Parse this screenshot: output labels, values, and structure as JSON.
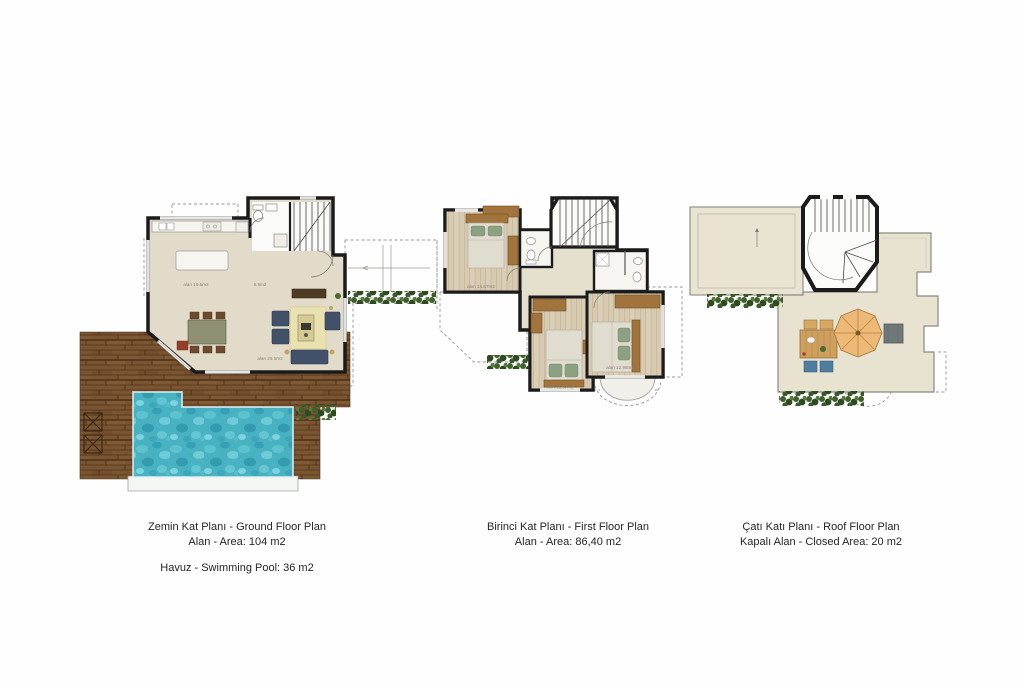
{
  "page": {
    "background": "#fefefe"
  },
  "plans": {
    "ground": {
      "caption1": "Zemin Kat Planı - Ground Floor Plan",
      "caption2": "Alan - Area: 104 m2",
      "caption3": "Havuz - Swimming Pool: 36 m2",
      "labels": {
        "kitchen": "alan 19.5m2",
        "hall": "9.5m2",
        "living": "alan 29.5m2"
      }
    },
    "first": {
      "caption1": "Birinci Kat Planı - First Floor Plan",
      "caption2": "Alan - Area: 86,40 m2",
      "labels": {
        "bedroom1": "alan 14.67m2",
        "bedroom2": "alan 11.57m2",
        "bedroom3": "alan 12.98m2"
      }
    },
    "roof": {
      "caption1": "Çatı Katı Planı - Roof Floor Plan",
      "caption2": "Kapalı Alan - Closed Area: 20 m2"
    }
  },
  "colors": {
    "wall": "#1b1b1b",
    "floor_beige": "#e2dbc9",
    "floor_wood_light": "#d8cab1",
    "deck_wood": "#7a5531",
    "pool_water": "#49b2c2",
    "hedge_green": "#3a5a2b",
    "sofa_blue": "#41516a",
    "rug_yellow": "#e9e1b0",
    "furniture_brown": "#a1743d",
    "umbrella_tan": "#ecb977",
    "cushion_blue": "#4f7d9e"
  }
}
